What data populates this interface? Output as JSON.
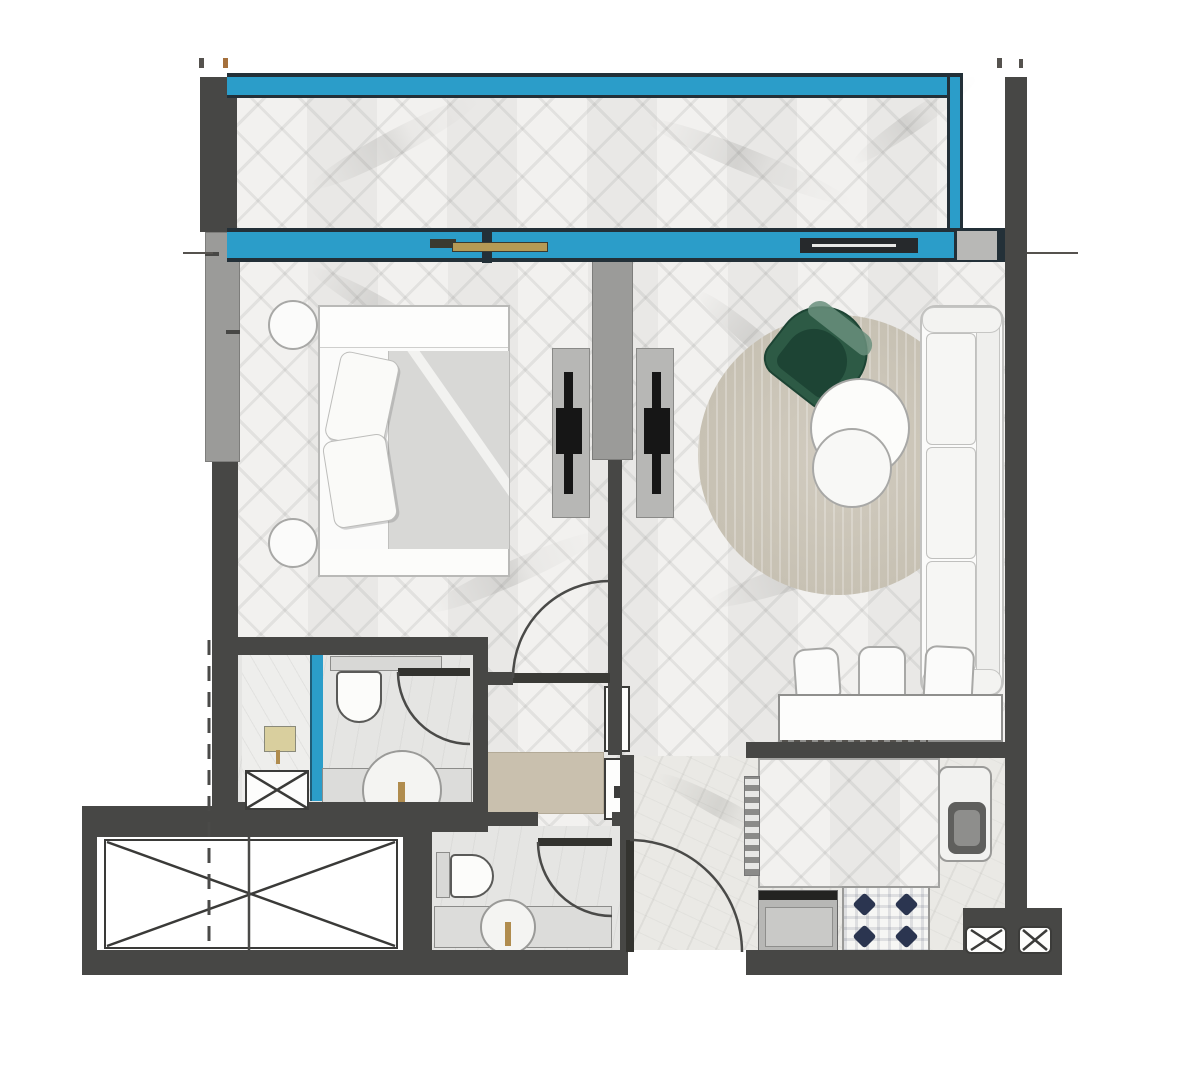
{
  "document": {
    "type": "apartment-floor-plan",
    "description": "Top-down rendered floor plan of a one-bedroom apartment with balcony; no readable text labels, dimension ticks only",
    "orientation": "balcony at top"
  },
  "palette": {
    "wall_dark": "#474745",
    "column_gray": "#9b9b99",
    "glazing_blue": "#2b9dc9",
    "glazing_frame": "#233038",
    "floor_light": "#f0efed",
    "bath_floor": "#e5e5e3",
    "marble_floor": "#eae9e5",
    "hall_rug_beige": "#c9c0ae",
    "living_rug_beige": "#ccc6b9",
    "armchair_green": "#2d5a45",
    "faucet_gold": "#b08c4e",
    "sliding_panel_tan": "#b59a55",
    "burner_navy": "#2b3550",
    "appliance_gray": "#b5b5b3"
  },
  "rooms": [
    {
      "id": "balcony",
      "name": "Balcony",
      "floor": "herringbone parquet",
      "features": [
        "glass balustrade on two sides"
      ]
    },
    {
      "id": "bedroom",
      "name": "Bedroom",
      "floor": "herringbone parquet",
      "furniture": [
        "double bed",
        "two round nightstands",
        "TV media panel"
      ]
    },
    {
      "id": "living-room",
      "name": "Living room",
      "floor": "herringbone parquet",
      "furniture": [
        "three-seat sofa",
        "green armchair",
        "two round coffee tables",
        "round area rug",
        "TV media panel",
        "breakfast counter",
        "three dining chairs"
      ]
    },
    {
      "id": "master-bathroom",
      "name": "Master bathroom",
      "floor": "stone tile",
      "fixtures": [
        "walk-in shower with blue glass screen",
        "toilet",
        "vanity with round basin and gold faucet",
        "service shaft"
      ]
    },
    {
      "id": "corridor",
      "name": "Corridor",
      "floor": "herringbone parquet",
      "features": [
        "beige runner rug",
        "two closet panels"
      ]
    },
    {
      "id": "guest-bathroom",
      "name": "Guest bathroom",
      "floor": "stone tile",
      "fixtures": [
        "toilet",
        "vanity with round basin and gold faucet"
      ]
    },
    {
      "id": "entry-hall",
      "name": "Entry hall",
      "floor": "stone tile",
      "features": [
        "entrance swing door in bottom wall"
      ]
    },
    {
      "id": "kitchen",
      "name": "Kitchen",
      "floor": "stone tile",
      "fixtures": [
        "oven",
        "four-burner hob",
        "sink unit",
        "island outline",
        "two service ducts"
      ]
    },
    {
      "id": "service-void",
      "name": "Service void / shaft",
      "features": [
        "large crossed rectangle",
        "dashed reference line",
        "solid division line"
      ]
    }
  ],
  "openings": {
    "swing_doors": [
      "bedroom-door",
      "master-bathroom-door",
      "guest-bathroom-door",
      "entrance-door"
    ],
    "sliding_glass_doors": [
      "bedroom-balcony-slider",
      "living-balcony-slider"
    ],
    "glazed_wall": "full-width blue glazing band between apartment and balcony"
  },
  "annotations": {
    "dimension_ticks_top": 4,
    "dimension_extension_lines": 2,
    "dashed_property_line": true,
    "crossed_shaft_boxes": 4
  }
}
